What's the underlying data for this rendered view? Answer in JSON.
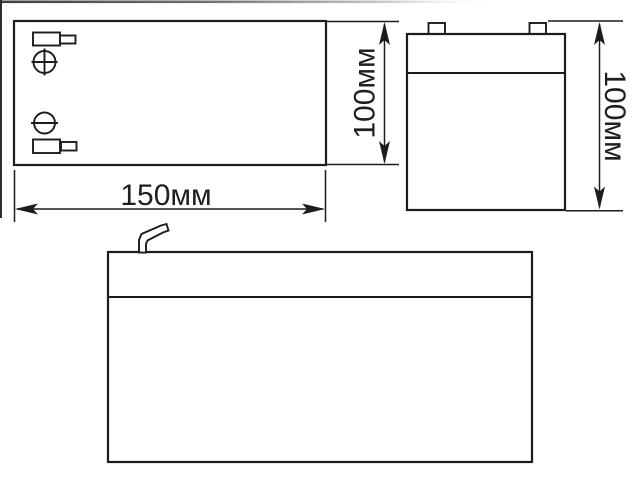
{
  "drawing": {
    "type": "battery-dimensional-drawing",
    "colors": {
      "outline": "#1c1c1c",
      "background": "#ffffff",
      "crop_border_gray": "#4a4a4a"
    },
    "views": {
      "top": {
        "name": "top-view",
        "positive_marker": "circle-plus-icon",
        "negative_marker": "circle-minus-icon",
        "terminal_tabs": 2
      },
      "side": {
        "name": "side-view",
        "terminal_tabs": 2
      },
      "front": {
        "name": "front-view",
        "terminal_tabs": 1
      }
    },
    "dimensions": {
      "width": {
        "label": "150мм"
      },
      "top_view_height": {
        "label": "100мм"
      },
      "overall_height": {
        "label": "100мм"
      }
    }
  }
}
